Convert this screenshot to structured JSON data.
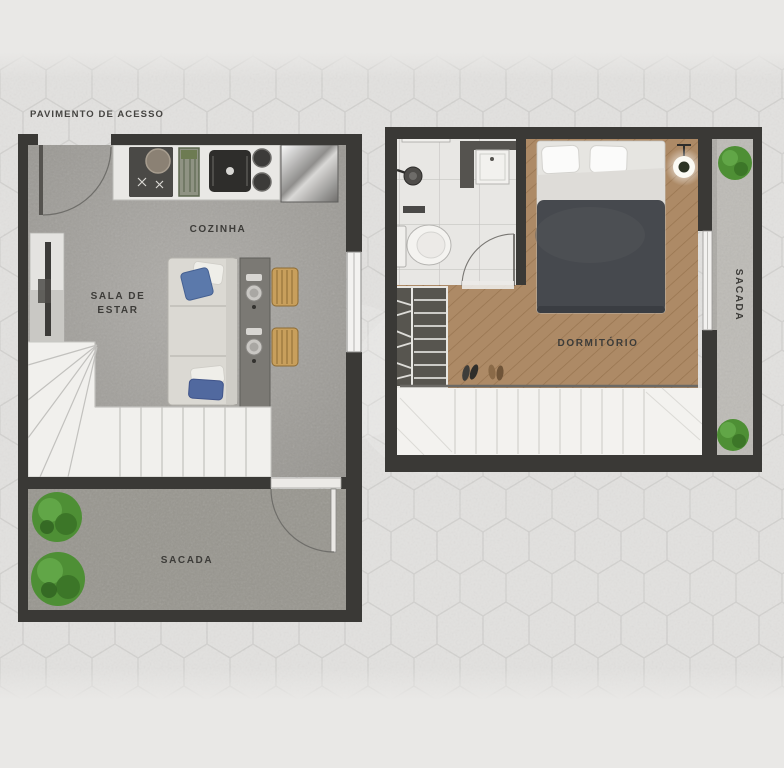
{
  "page": {
    "floor_label": "PAVIMENTO DE ACESSO"
  },
  "access_floor": {
    "kitchen_label": "COZINHA",
    "living_label_line1": "SALA DE",
    "living_label_line2": "ESTAR",
    "balcony_label": "SACADA"
  },
  "upper_floor": {
    "bedroom_label": "DORMITÓRIO",
    "balcony_label": "SACADA"
  },
  "colors": {
    "background": "#e7e6e4",
    "hex_line": "#c5c4c1",
    "wall": "#3a3936",
    "concrete_floor": "#a3a19d",
    "balcony_floor": "#98968f",
    "wood_floor": "#ad8a66",
    "bathroom_tile": "#e8e7e4",
    "stairs": "#f2f1ee",
    "duvet": "#46494e",
    "pillow_blue": "#5b79ab",
    "stool_wood": "#c89f5c",
    "plant_green": "#4e8f35"
  }
}
